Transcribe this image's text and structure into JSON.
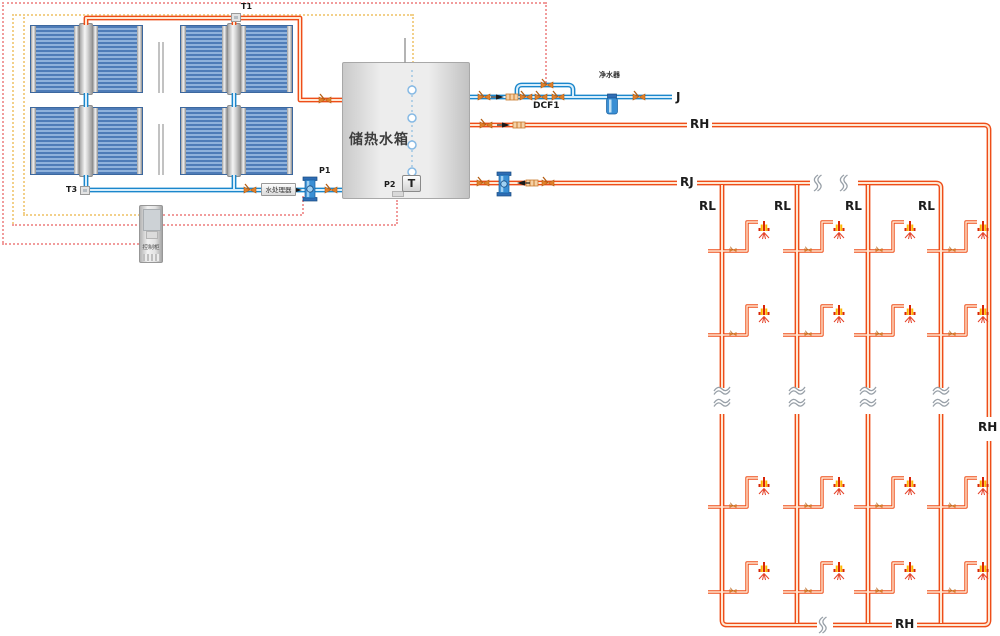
{
  "labels": {
    "sensor_t1": "T1",
    "sensor_t3": "T3",
    "pump_p1": "P1",
    "pump_p2": "P2",
    "valve_dcf1": "DCF1",
    "cold_main": "J",
    "hot_supply": "RJ",
    "return_top": "RH",
    "return_right": "RH",
    "return_bottom": "RH",
    "riser": "RL",
    "tank_name": "储热水箱",
    "tank_temp_sensor": "T",
    "water_processor": "水处理器",
    "water_purifier": "净水器",
    "control_cabinet": "控制柜"
  },
  "network": {
    "riser_count": 4,
    "riser_labels": [
      "RL",
      "RL",
      "RL",
      "RL"
    ],
    "showers_per_riser": 4,
    "shower_total": 16
  },
  "colors": {
    "hot_pipe": "#ee4d18",
    "hot_pipe_core": "#ffe7d2",
    "cold_pipe": "#1b87cc",
    "cold_pipe_core": "#d8eefb",
    "control_wire_red": "#f19c9c",
    "control_wire_yellow": "#f2d08a",
    "panel_blue": "#6f9fd2",
    "tank_gray": "#e3e3e3",
    "shower_red": "#d92506",
    "shower_yellow": "#ffb703",
    "valve_orange": "#e0802a",
    "break_gray": "#98a0a8"
  }
}
